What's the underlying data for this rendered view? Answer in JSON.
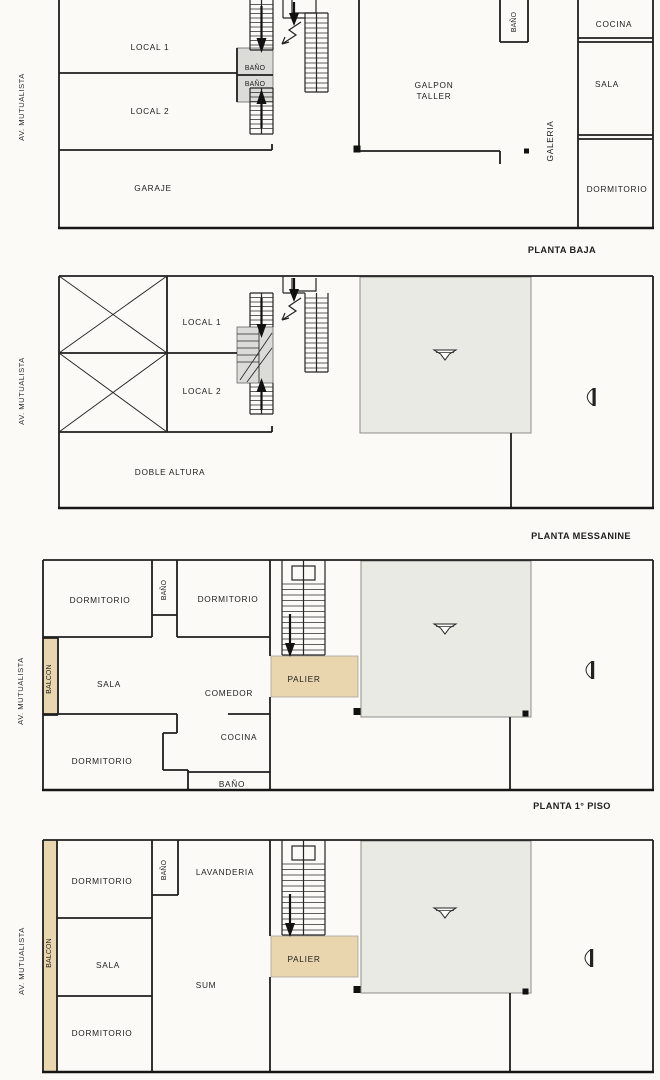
{
  "street_label": "AV. MUTUALISTA",
  "colors": {
    "paper": "#fbfaf7",
    "wall": "#1f1f1f",
    "shade_gray": "#dbdbd7",
    "unit_gray": "#eaeae5",
    "tan": "#e9d6ae"
  },
  "icons": {
    "stair_down_arrow": "down-arrow-icon",
    "stair_up_arrow": "up-arrow-icon",
    "stair_break": "stair-break-arrow-icon",
    "ceiling_fixture": "ceiling-fixture-icon",
    "door_swing": "door-swing-icon",
    "column": "column-marker",
    "void_cross": "double-height-x-icon"
  },
  "plans": [
    {
      "title": "PLANTA BAJA",
      "rooms": {
        "local1": "LOCAL 1",
        "local2": "LOCAL 2",
        "garaje": "GARAJE",
        "bano_upper": "BAÑO",
        "bano_lower": "BAÑO",
        "bano_galpon": "BAÑO",
        "galpon_line1": "GALPON",
        "galpon_line2": "TALLER",
        "galeria": "GALERIA",
        "cocina": "COCINA",
        "sala": "SALA",
        "dormitorio": "DORMITORIO"
      }
    },
    {
      "title": "PLANTA MESSANINE",
      "rooms": {
        "local1": "LOCAL 1",
        "local2": "LOCAL 2",
        "doble_altura": "DOBLE ALTURA"
      }
    },
    {
      "title": "PLANTA 1° PISO",
      "rooms": {
        "dormitorio1": "DORMITORIO",
        "bano1": "BAÑO",
        "dormitorio2": "DORMITORIO",
        "balcon": "BALCON",
        "sala": "SALA",
        "comedor": "COMEDOR",
        "palier": "PALIER",
        "dormitorio3": "DORMITORIO",
        "cocina": "COCINA",
        "bano2": "BAÑO"
      }
    },
    {
      "rooms": {
        "dormitorio1": "DORMITORIO",
        "bano": "BAÑO",
        "lavanderia": "LAVANDERIA",
        "balcon": "BALCON",
        "sala": "SALA",
        "sum": "SUM",
        "palier": "PALIER",
        "dormitorio2": "DORMITORIO"
      }
    }
  ]
}
